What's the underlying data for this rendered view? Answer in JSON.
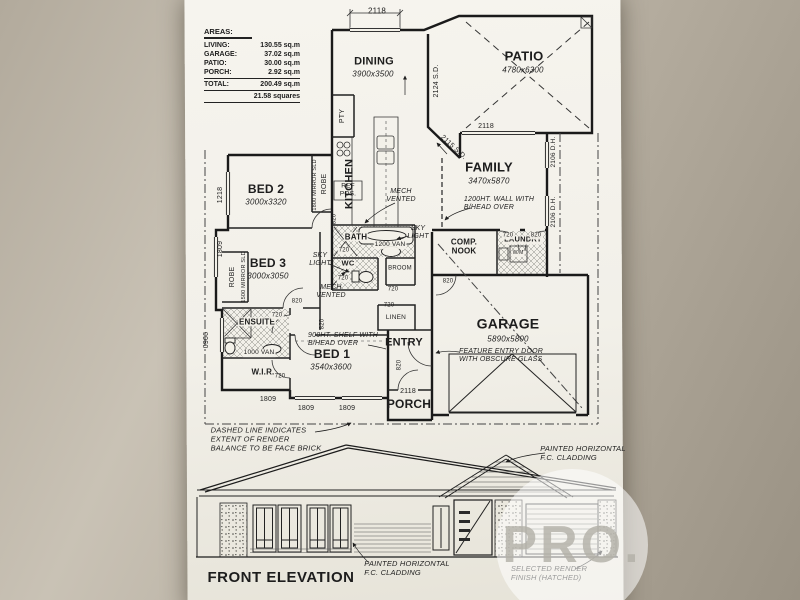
{
  "areas": {
    "title": "AREAS:",
    "rows": [
      {
        "label": "LIVING:",
        "value": "130.55 sq.m"
      },
      {
        "label": "GARAGE:",
        "value": "37.02 sq.m"
      },
      {
        "label": "PATIO:",
        "value": "30.00 sq.m"
      },
      {
        "label": "PORCH:",
        "value": "2.92 sq.m"
      }
    ],
    "total": {
      "label": "TOTAL:",
      "value": "200.49 sq.m"
    },
    "squares": "21.58 squares"
  },
  "rooms": {
    "dining": {
      "name": "DINING",
      "size": "3900x3500"
    },
    "patio": {
      "name": "PATIO",
      "size": "4780x6300"
    },
    "kitchen": {
      "name": "KITCHEN"
    },
    "pantry": {
      "name": "PTY"
    },
    "family": {
      "name": "FAMILY",
      "size": "3470x5870"
    },
    "bed1": {
      "name": "BED 1",
      "size": "3540x3600"
    },
    "bed2": {
      "name": "BED 2",
      "size": "3000x3320"
    },
    "bed3": {
      "name": "BED 3",
      "size": "3000x3050"
    },
    "garage": {
      "name": "GARAGE",
      "size": "5890x5800"
    },
    "entry": {
      "name": "ENTRY"
    },
    "porch": {
      "name": "PORCH"
    },
    "ensuite": {
      "name": "ENSUITE"
    },
    "wir": {
      "name": "W.I.R."
    },
    "bath": {
      "name": "BATH"
    },
    "wc": {
      "name": "WC"
    },
    "broom": {
      "name": "BROOM"
    },
    "linen": {
      "name": "LINEN"
    },
    "comp_nook": {
      "name": "COMP.\nNOOK"
    },
    "laundry": {
      "name": "LAUNDRY"
    }
  },
  "fixtures": {
    "ref": "REF\nPOS.",
    "robe": "ROBE",
    "mirror_1800": "1800 MIRROR SLD",
    "mirror_1500": "1500 MIRROR SLD",
    "van_1200": "1200 VAN",
    "van_1000": "1000 VAN",
    "wm": "W/M"
  },
  "dims": {
    "d2118": "2118",
    "d2124": "2124 S.D.",
    "d2115": "2115 S.D.",
    "d2106": "2106 D.H.",
    "d1218": "1218",
    "d1809": "1809",
    "d0906": "0906",
    "w820": "820",
    "w720": "720"
  },
  "notes": {
    "mech_vented": "MECH\nVENTED",
    "sky_light": "SKY\nLIGHT",
    "wall_1200": "1200HT. WALL WITH\nB/HEAD OVER",
    "shelf_900": "900HT. SHELF WITH\nB/HEAD OVER",
    "feature_door": "FEATURE ENTRY DOOR\nWITH OBSCURE GLASS",
    "render_note": "DASHED LINE INDICATES\nEXTENT OF RENDER\nBALANCE TO BE FACE BRICK",
    "cladding": "PAINTED HORIZONTAL\nF.C. CLADDING",
    "render_finish": "SELECTED RENDER\nFINISH (HATCHED)"
  },
  "elevation": {
    "title": "FRONT ELEVATION"
  },
  "watermark": {
    "text": "PRO."
  }
}
